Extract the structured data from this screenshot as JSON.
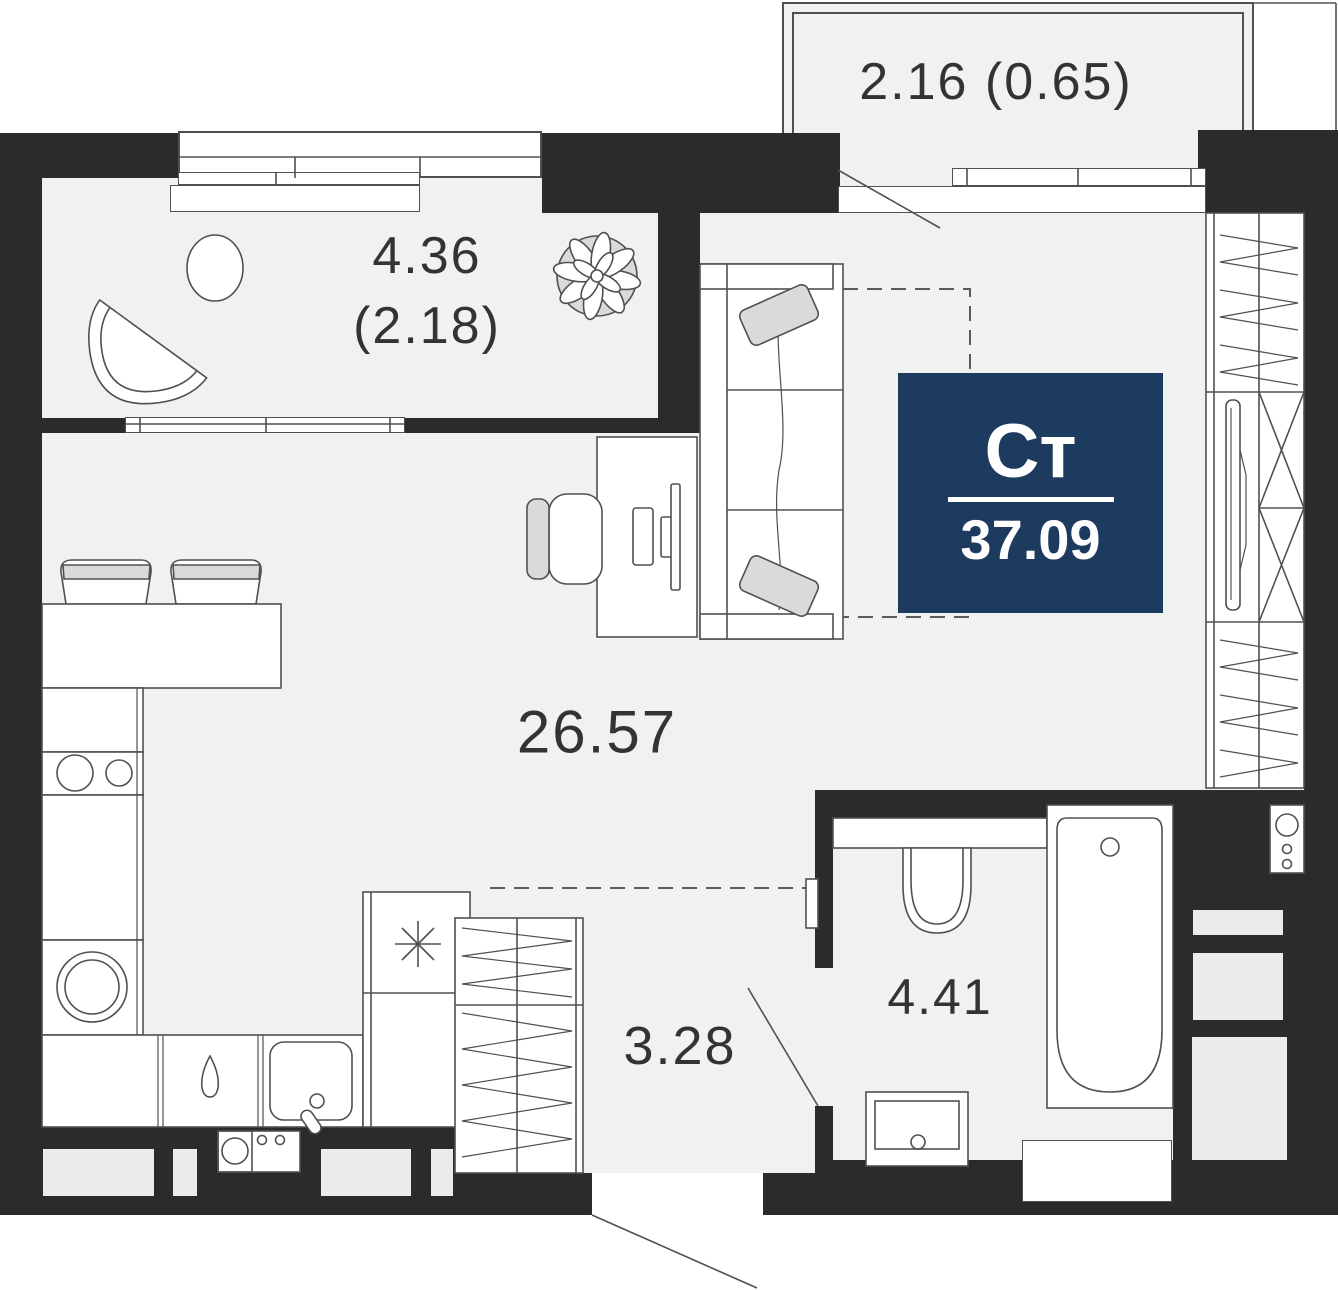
{
  "floorplan": {
    "unit_badge": {
      "type_label": "Ст",
      "total_area": "37.09"
    },
    "rooms": {
      "balcony_top": {
        "area_label": "2.16 (0.65)"
      },
      "balcony_left": {
        "area_label": "4.36",
        "secondary_area_label": "(2.18)"
      },
      "living_room": {
        "area_label": "26.57"
      },
      "hallway": {
        "area_label": "3.28"
      },
      "bathroom": {
        "area_label": "4.41"
      }
    },
    "icons": {
      "plant": "plant-icon",
      "freezer_star": "asterisk-icon",
      "hob_burners": "two-circles",
      "washing_machine": "double-circle"
    },
    "colors": {
      "wall": "#2b2b2d",
      "floor": "#f0f1f1",
      "line": "#4f5052",
      "text": "#333333",
      "badge_bg": "#1d3a5f",
      "badge_text": "#ffffff",
      "furniture_fill": "#ffffff",
      "pillow_fill": "#d9dadb",
      "inset": "#eaebeb"
    }
  }
}
